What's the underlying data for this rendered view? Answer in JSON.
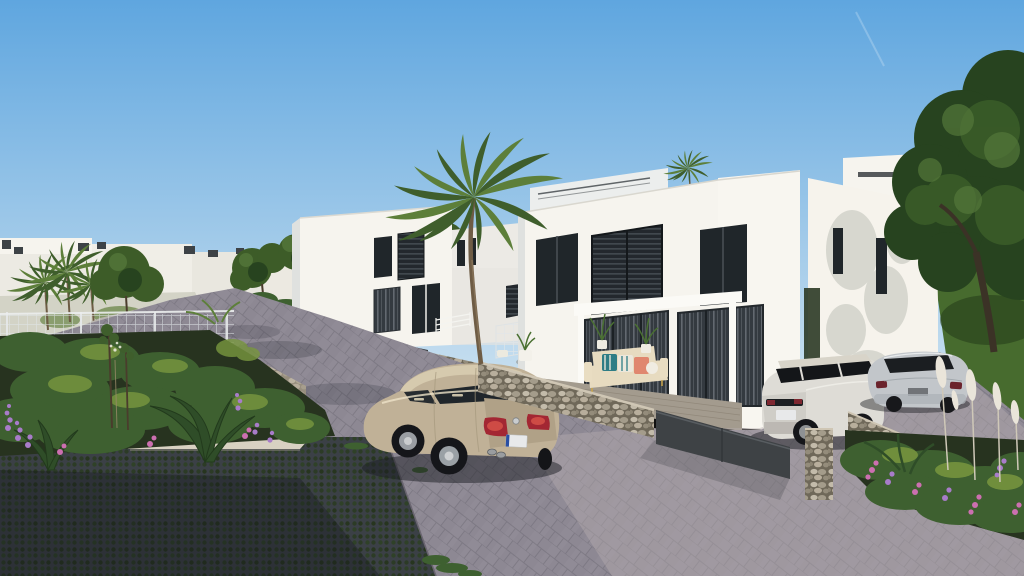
{
  "scene": {
    "kind": "3d-architectural-exterior-render",
    "subject": "modern-white-villa-development-with-paved-street-cars-and-gardens",
    "objects": [
      "sky",
      "contrail",
      "distant-villas",
      "roof-vents",
      "uphill-street",
      "stone-retaining-wall",
      "center-left-villa",
      "background-villa",
      "main-duplex-villa",
      "louvered-window",
      "sliding-glass-doors",
      "pergola",
      "terrace-deck",
      "outdoor-sofa",
      "potted-plants",
      "right-villa",
      "roof-parapet",
      "large-tree",
      "lawn-slope",
      "palm-tree",
      "wire-mesh-fence",
      "gabion-walls",
      "metal-gate-panel",
      "paver-road",
      "grass-grid-paving",
      "white-hatchback-car",
      "beige-sedan-car",
      "white-suv",
      "silver-coupe",
      "planting-beds",
      "purple-flowers",
      "pink-flowers",
      "pampas-plumes",
      "young-staked-trees",
      "license-plates"
    ]
  },
  "colors": {
    "sky_top": "#5fa6df",
    "sky_horizon": "#cde2f0",
    "wall_lit": "#f6f4ee",
    "wall_shade": "#dfe1df",
    "window_dark": "#20262a",
    "road_mid": "#8d8893",
    "road_lit": "#b7adb0",
    "road_shadow": "#262a33",
    "uphill_road": "#b8b4ae",
    "path_light": "#d8d1c2",
    "grass_grid": "#3b4046",
    "gabion_base": "#6f6859",
    "stone_light": "#b7ad9c",
    "fence_panel": "#3e4245",
    "mesh": "#e1e6e9",
    "hedge": "#2c3a26",
    "lawn": "#476b2e",
    "lawn_light": "#5d8136",
    "tree_dark": "#27431f",
    "tree_mid": "#3d5c28",
    "palm_green": "#3f5e2c",
    "palm_light": "#5d7f3a",
    "palm_trunk": "#6e5c45",
    "trunk_brown": "#4a3c2c",
    "bush_green": "#3e6030",
    "bush_light": "#79973f",
    "flower_purple": "#a87cc9",
    "flower_pink": "#cc6fb0",
    "plume_white": "#eae5da",
    "sedan_beige": "#c0b197",
    "taillight_red": "#a32733",
    "suv_body": "#dedcd6",
    "suv_glass": "#141619",
    "coupe_body": "#c2c6ca",
    "hatch_body": "#e9eae8",
    "sofa_cream": "#e7dbc0",
    "cushion_teal": "#2f7d85",
    "cushion_coral": "#e0876f",
    "terrace_deck": "#a39b8e",
    "plate_white": "#e8e9ea",
    "plate_blue": "#2a4fa3"
  }
}
